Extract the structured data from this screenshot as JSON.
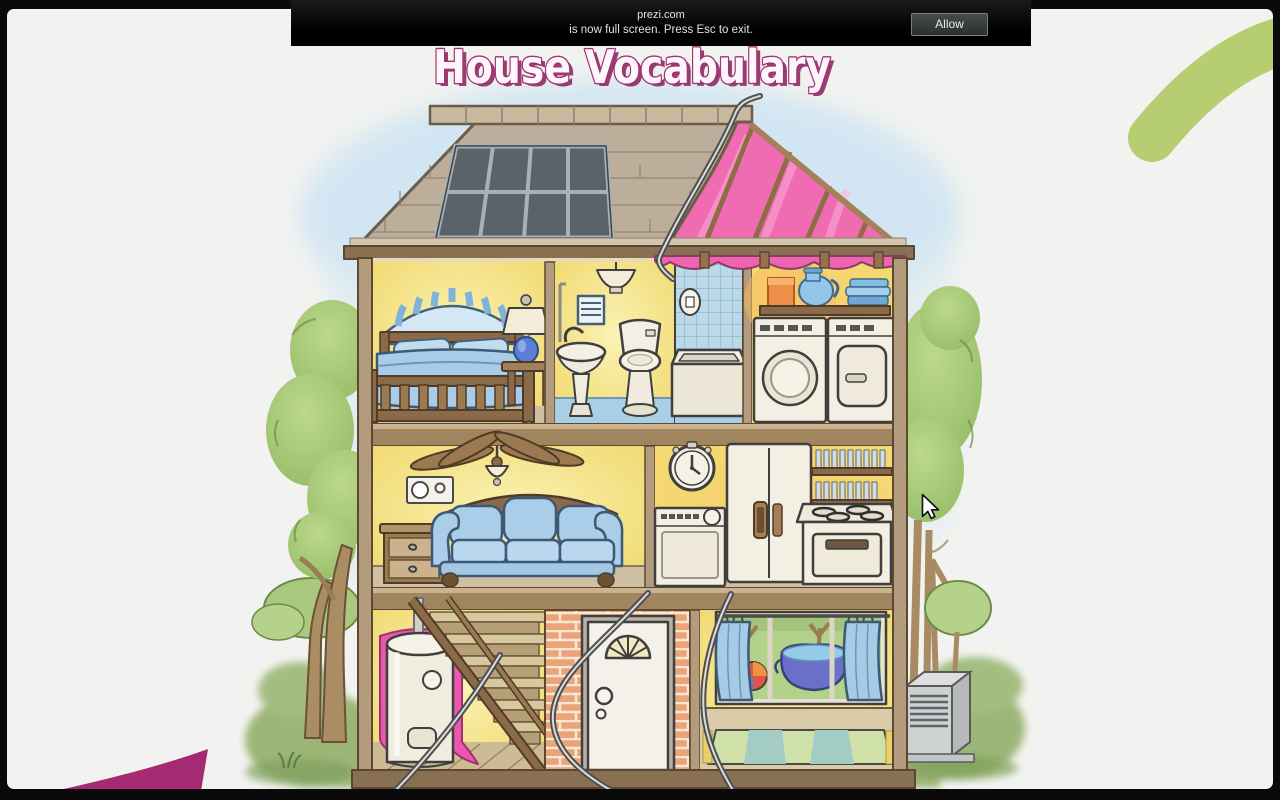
{
  "chrome": {
    "fullscreen_notice": {
      "site": "prezi.com",
      "message": "is now full screen. Press Esc to exit.",
      "allow_label": "Allow"
    }
  },
  "slide": {
    "title": "House Vocabulary"
  },
  "illustration": {
    "type": "watercolor-cutaway-house",
    "rooms": [
      "attic roof with skylight",
      "bedroom",
      "bathroom",
      "shower",
      "laundry room",
      "living room",
      "kitchen",
      "basement stairs and water heater",
      "front entry with door",
      "playroom with backyard window"
    ],
    "exterior": [
      "trees",
      "bushes",
      "grass",
      "air conditioner unit"
    ]
  },
  "decor": {
    "corner_shapes": [
      "green arc top-right",
      "magenta wedge bottom-left"
    ]
  },
  "colors": {
    "accent_pink": "#a93075",
    "accent_green": "#b7cd72",
    "notice_bg": "#0a0a0a",
    "roof_pink": "#ef6cb2",
    "wall_yellow": "#f6df75"
  }
}
